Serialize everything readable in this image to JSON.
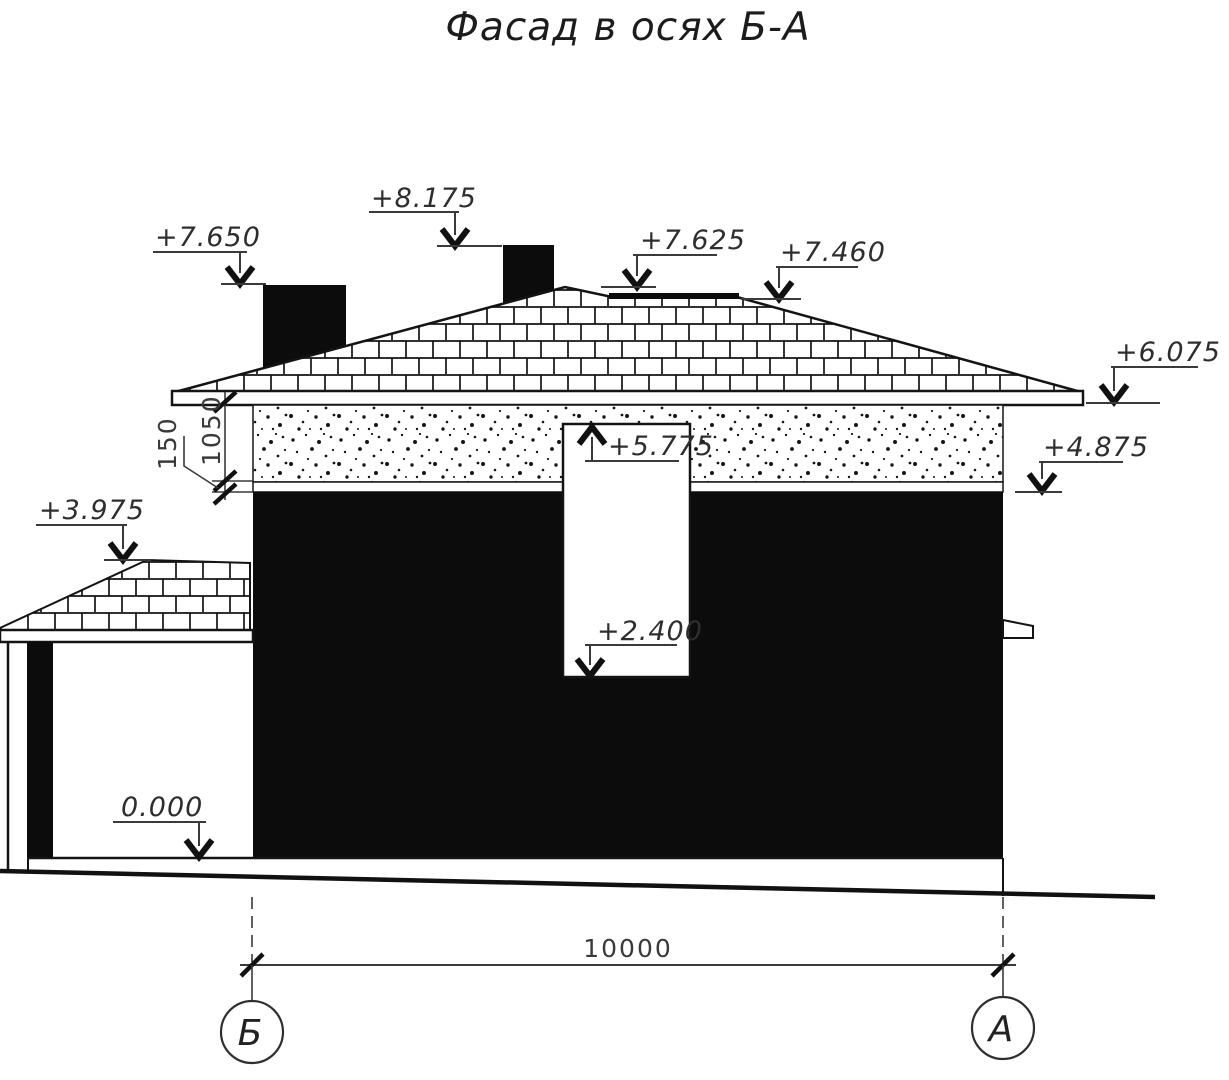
{
  "title": "Фасад в осях Б-А",
  "markers": {
    "chimney_left_top": "+7.650",
    "chimney_right_top": "+8.175",
    "roof_peak": "+7.625",
    "roof_ridge": "+7.460",
    "eave": "+6.075",
    "wall_top": "+4.875",
    "opening_top": "+5.775",
    "opening_bottom": "+2.400",
    "porch_roof_top": "+3.975",
    "ground_floor": "0.000"
  },
  "dimensions": {
    "overall_width": "10000",
    "band_height": "1050",
    "fascia_height": "150"
  },
  "axes": {
    "left": "Б",
    "right": "А"
  },
  "colors": {
    "ink": "#141414",
    "dim_gray": "#3a3a3a",
    "paper": "#ffffff"
  }
}
